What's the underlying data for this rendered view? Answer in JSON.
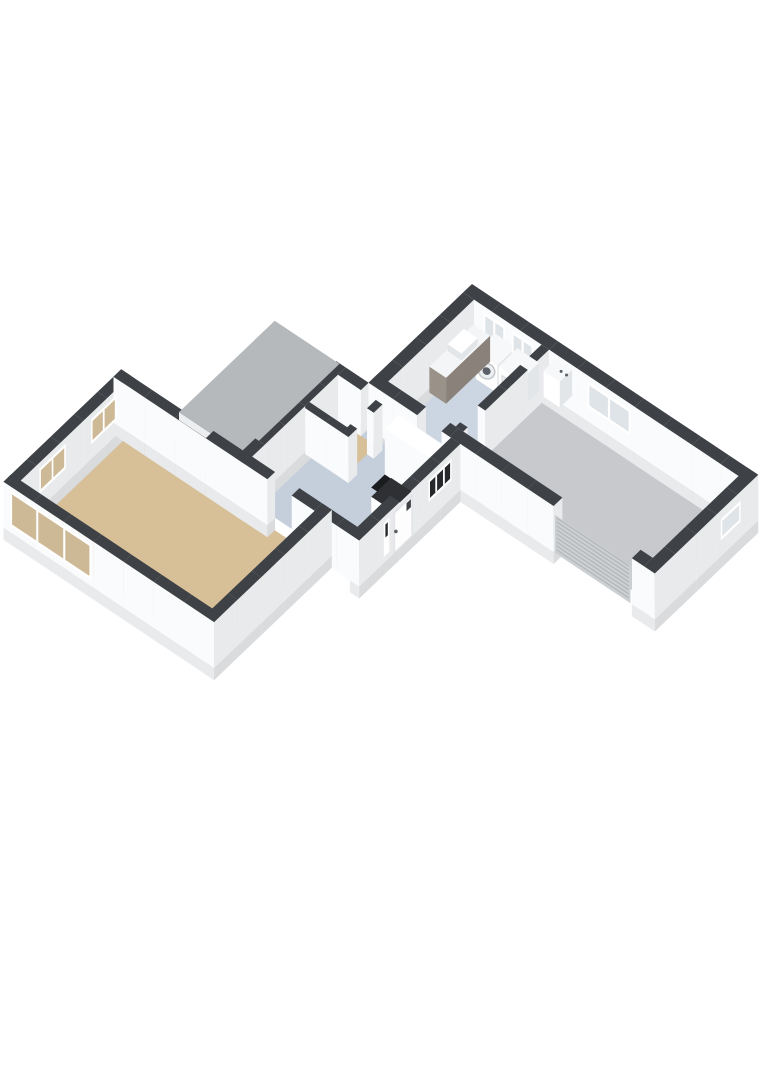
{
  "scene": {
    "width": 764,
    "height": 1080,
    "background": "#ffffff",
    "type": "3d-floorplan-render"
  },
  "rooms": [
    {
      "name": "living-room",
      "floor": "floor_wood"
    },
    {
      "name": "hallway",
      "floor": "floor_hall"
    },
    {
      "name": "toilet",
      "floor": "floor_wood"
    },
    {
      "name": "staircase",
      "floor": "stair_void"
    },
    {
      "name": "utility-room",
      "floor": "floor_utility"
    },
    {
      "name": "garage",
      "floor": "floor_garage"
    }
  ],
  "plan": {
    "projection": {
      "origin": [
        472,
        330
      ],
      "axis_p": [
        27,
        18
      ],
      "axis_q": [
        -22,
        21
      ],
      "wall_height": 46,
      "plinth_depth": 12
    },
    "colors": {
      "wall_top": "#3e4145",
      "face_sw": "#fafbfc",
      "face_se": "#e8eaec",
      "plinth_sw": "#e9eaec",
      "plinth_se": "#d9dbdd",
      "floor_wood": "#d7bf98",
      "floor_hall": "#c5cedb",
      "floor_utility": "#ccd6e2",
      "floor_garage": "#c7c9cc",
      "stair_void": "#1b1c1e",
      "roof_slab": "#b6b9bc",
      "roof_fascia": "#eceef0",
      "glass_sky": "#dfe4e9",
      "glass_dark": "#26282b",
      "glass_interior": "#cdb995",
      "frame": "#ffffff",
      "door_frame": "#e2e4e7",
      "door_leaf": "#fdfdfe",
      "roller": "#cdd0d3",
      "roller_slat": "#b3b6b9",
      "appliance": "#f7f8f9",
      "appliance_side": "#e3e6e8",
      "counter_body": "#9a9189",
      "counter_body_se": "#89817a",
      "counter_top": "#f4f5f6",
      "cabinet_top": "#2e3034",
      "metal_dark": "#5a6066",
      "washer_ring": "#c3c7ca",
      "washer_face": "#eceff1"
    },
    "floors": [
      {
        "name": "floor-utility-room",
        "rect": [
          0.4,
          0.4,
          2.9,
          4.3
        ],
        "color": "floor_utility"
      },
      {
        "name": "floor-garage",
        "rect": [
          3.18,
          0.4,
          10.2,
          4.3
        ],
        "color": "floor_garage"
      },
      {
        "name": "floor-hallway",
        "rect": [
          -0.85,
          4.7,
          3.05,
          8.95
        ],
        "color": "floor_hall"
      },
      {
        "name": "floor-toilet",
        "rect": [
          -0.85,
          5.05,
          0.55,
          6.35
        ],
        "color": "floor_wood"
      },
      {
        "name": "floor-stair-void",
        "rect": [
          1.4,
          5.05,
          3.05,
          6.3
        ],
        "color": "stair_void"
      },
      {
        "name": "floor-living-room",
        "rect": [
          -5.35,
          9.3,
          1.75,
          13.95
        ],
        "color": "floor_wood"
      }
    ],
    "walls": [
      {
        "name": "garage-ne-wall",
        "rect": [
          0,
          0,
          10.6,
          0.4
        ],
        "ext": true
      },
      {
        "name": "garage-se-wall",
        "rect": [
          10.2,
          0,
          10.6,
          4.7
        ],
        "ext": true
      },
      {
        "name": "garage-sw-wall-left",
        "rect": [
          3.0,
          4.3,
          6.85,
          4.7
        ],
        "ext": true
      },
      {
        "name": "garage-sw-wall-right",
        "rect": [
          9.75,
          4.3,
          10.2,
          4.7
        ],
        "ext": true
      },
      {
        "name": "utility-nw-wall",
        "rect": [
          0,
          0.4,
          0.4,
          4.7
        ],
        "ext": true
      },
      {
        "name": "utility-garage-partition",
        "rect": [
          2.9,
          0.4,
          3.18,
          3.3
        ]
      },
      {
        "name": "utility-garage-partition-end",
        "rect": [
          2.9,
          4.1,
          3.18,
          4.3
        ]
      },
      {
        "name": "utility-hall-wall",
        "rect": [
          0,
          4.3,
          1.8,
          4.7
        ]
      },
      {
        "name": "utility-hall-wall-end",
        "rect": [
          2.7,
          4.3,
          3.0,
          4.7
        ]
      },
      {
        "name": "hall-nw-wall",
        "rect": [
          -1.2,
          4.7,
          -0.85,
          9.3
        ],
        "ext": true
      },
      {
        "name": "hall-nw-link-wall",
        "rect": [
          -0.85,
          4.7,
          0,
          5.05
        ]
      },
      {
        "name": "entry-se-wall",
        "rect": [
          3.05,
          4.7,
          3.4,
          9.3
        ],
        "ext": true
      },
      {
        "name": "living-ne-wall",
        "rect": [
          -5.7,
          8.95,
          0,
          9.3
        ],
        "ext": true
      },
      {
        "name": "living-ne-wall-east",
        "rect": [
          0.9,
          8.95,
          3.4,
          9.3
        ]
      },
      {
        "name": "toilet-se-wall",
        "rect": [
          0.55,
          5.05,
          0.8,
          5.45
        ]
      },
      {
        "name": "toilet-se-wall-south",
        "rect": [
          0.55,
          6.2,
          0.8,
          6.6
        ]
      },
      {
        "name": "toilet-sw-wall",
        "rect": [
          -0.85,
          6.35,
          0.8,
          6.6
        ]
      },
      {
        "name": "living-nw-wall",
        "rect": [
          -5.7,
          8.95,
          -5.35,
          14.3
        ],
        "ext": true
      },
      {
        "name": "living-sw-wall",
        "rect": [
          -5.7,
          13.95,
          2.1,
          14.3
        ],
        "ext": true
      },
      {
        "name": "living-se-wall",
        "rect": [
          1.75,
          8.95,
          2.1,
          14.3
        ],
        "ext": true
      },
      {
        "name": "leanto-end-wall",
        "rect": [
          -3.55,
          8.55,
          -1.2,
          8.9
        ],
        "h": 32,
        "ext": true
      }
    ],
    "roof": {
      "name": "leanto-roof-slab",
      "top_rect": [
        -3.6,
        4.55,
        -1.2,
        8.9
      ],
      "height": 40,
      "fascia": 8
    },
    "windows": [
      {
        "name": "utility-window-1",
        "face": "q",
        "at": 0.4,
        "from": 0.75,
        "to": 1.55,
        "sill": 16,
        "head": 40,
        "glass": "glass_sky",
        "mull": 1
      },
      {
        "name": "utility-window-2",
        "face": "q",
        "at": 0.4,
        "from": 1.8,
        "to": 2.6,
        "sill": 16,
        "head": 40,
        "glass": "glass_sky",
        "mull": 1
      },
      {
        "name": "garage-window-ne",
        "face": "q",
        "at": 0.4,
        "from": 4.6,
        "to": 6.2,
        "sill": 14,
        "head": 40,
        "glass": "glass_sky",
        "mull": 1
      },
      {
        "name": "garage-window-se",
        "face": "p",
        "at": 10.6,
        "from": 0.8,
        "to": 1.7,
        "sill": 16,
        "head": 37,
        "glass": "glass_sky",
        "mull": 0
      },
      {
        "name": "stair-window",
        "face": "p",
        "at": 3.4,
        "from": 5.1,
        "to": 6.15,
        "sill": 18,
        "head": 40,
        "glass": "glass_dark",
        "mull": 2
      },
      {
        "name": "door-sidelight",
        "face": "p",
        "at": 3.4,
        "from": 7.93,
        "to": 8.18,
        "sill": 6,
        "head": 40,
        "glass": "glass_dark",
        "glass_sill": 24,
        "mull": 0
      },
      {
        "name": "living-window-nw-1",
        "face": "p",
        "at": -5.35,
        "from": 9.6,
        "to": 10.75,
        "sill": 15,
        "head": 40,
        "glass": "glass_interior",
        "mull": 1
      },
      {
        "name": "living-window-nw-2",
        "face": "p",
        "at": -5.35,
        "from": 11.9,
        "to": 13.1,
        "sill": 15,
        "head": 40,
        "glass": "glass_interior",
        "mull": 1
      },
      {
        "name": "living-window-sw",
        "face": "q",
        "at": 14.3,
        "from": -5.45,
        "to": -2.45,
        "sill": 6,
        "head": 42,
        "glass": "glass_interior",
        "mull": 2
      }
    ],
    "door": {
      "name": "front-door",
      "face": "p",
      "at": 3.4,
      "from": 6.85,
      "to": 7.75,
      "sill": 0,
      "head": 42
    },
    "roller_door": {
      "name": "garage-roller-door",
      "face": "q",
      "at": 4.7,
      "from": 6.9,
      "to": 9.7,
      "h": 38
    },
    "fixtures": [
      {
        "name": "laundry-counter",
        "box": [
          0.5,
          0.55,
          1.12,
          2.55,
          0,
          26
        ],
        "top": "counter_top",
        "qf": "counter_body",
        "pf": "counter_body_se"
      },
      {
        "name": "laundry-sink",
        "box": [
          0.55,
          1.05,
          1.06,
          1.78,
          26,
          33
        ],
        "top": "frame",
        "qf": "appliance_side",
        "pf": "appliance_side",
        "dz": 0.9
      },
      {
        "name": "washing-machine",
        "box": [
          1.2,
          0.45,
          2.0,
          1.3,
          0,
          28
        ],
        "top": "appliance",
        "qf": "frame",
        "pf": "appliance_side",
        "extra": "washer"
      },
      {
        "name": "dryer",
        "box": [
          2.05,
          0.45,
          2.85,
          1.3,
          0,
          28
        ],
        "top": "appliance",
        "qf": "frame",
        "pf": "appliance_side",
        "extra": "dryer"
      },
      {
        "name": "boiler",
        "box": [
          3.45,
          0.42,
          4.05,
          0.98,
          16,
          42
        ],
        "top": "appliance",
        "qf": "frame",
        "pf": "appliance_side",
        "extra": "boiler"
      },
      {
        "name": "stair-block",
        "box": [
          1.4,
          5.05,
          3.05,
          5.68,
          0,
          46
        ],
        "top": "frame",
        "qf": "face_sw",
        "pf": "face_se",
        "dz": -0.9
      },
      {
        "name": "hall-cabinet",
        "box": [
          2.3,
          6.5,
          3.05,
          7.4,
          0,
          30
        ],
        "top": "cabinet_top",
        "qf": "frame",
        "pf": "face_se"
      }
    ]
  }
}
